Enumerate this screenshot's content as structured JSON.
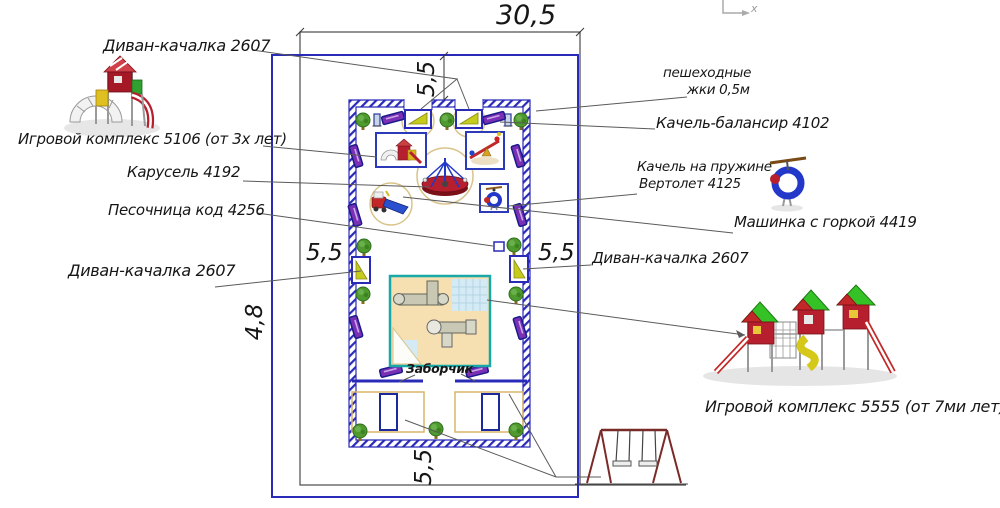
{
  "drawing": {
    "title_hint": "playground site plan",
    "dimensions": {
      "site_width": "30,5",
      "site_height": "4,8",
      "offset_top": "5,5",
      "offset_left": "5,5",
      "offset_right": "5,5",
      "offset_bottom": "5,5"
    },
    "labels": {
      "divan_top": "Диван-качалка 2607",
      "complex_5106": "Игровой комплекс 5106 (от 3х лет)",
      "karusel": "Карусель 4192",
      "pesochnitsa": "Песочница код 4256",
      "divan_left": "Диван-качалка 2607",
      "peshehodnye_line1": "пешеходные",
      "peshehodnye_line2": "жки 0,5м",
      "balansir": "Качель-балансир 4102",
      "pruzhina_line1": "Качель на пружине",
      "pruzhina_line2": "Вертолет 4125",
      "mashinka": "Машинка с горкой 4419",
      "divan_right": "Диван-качалка 2607",
      "complex_5555": "Игровой комплекс 5555 (от 7ми лет)",
      "zaborchik": "Заборчик"
    },
    "corner_symbol": "x",
    "colors": {
      "plot_line_blue": "#2a2ab8",
      "site_line_black": "#4a4a4a",
      "leader_line": "#5a5a5a",
      "bench_purple": "#7a2fb5",
      "rocker_yellow": "#c6cc1e",
      "tree_green": "#4e9a2e",
      "safety_zone_tan": "#d8c48a",
      "plan_fill": "#f6dfb0",
      "plan_border_teal": "#18a8a8",
      "equipment_red": "#b51f2e",
      "roof_green": "#35c227"
    }
  }
}
